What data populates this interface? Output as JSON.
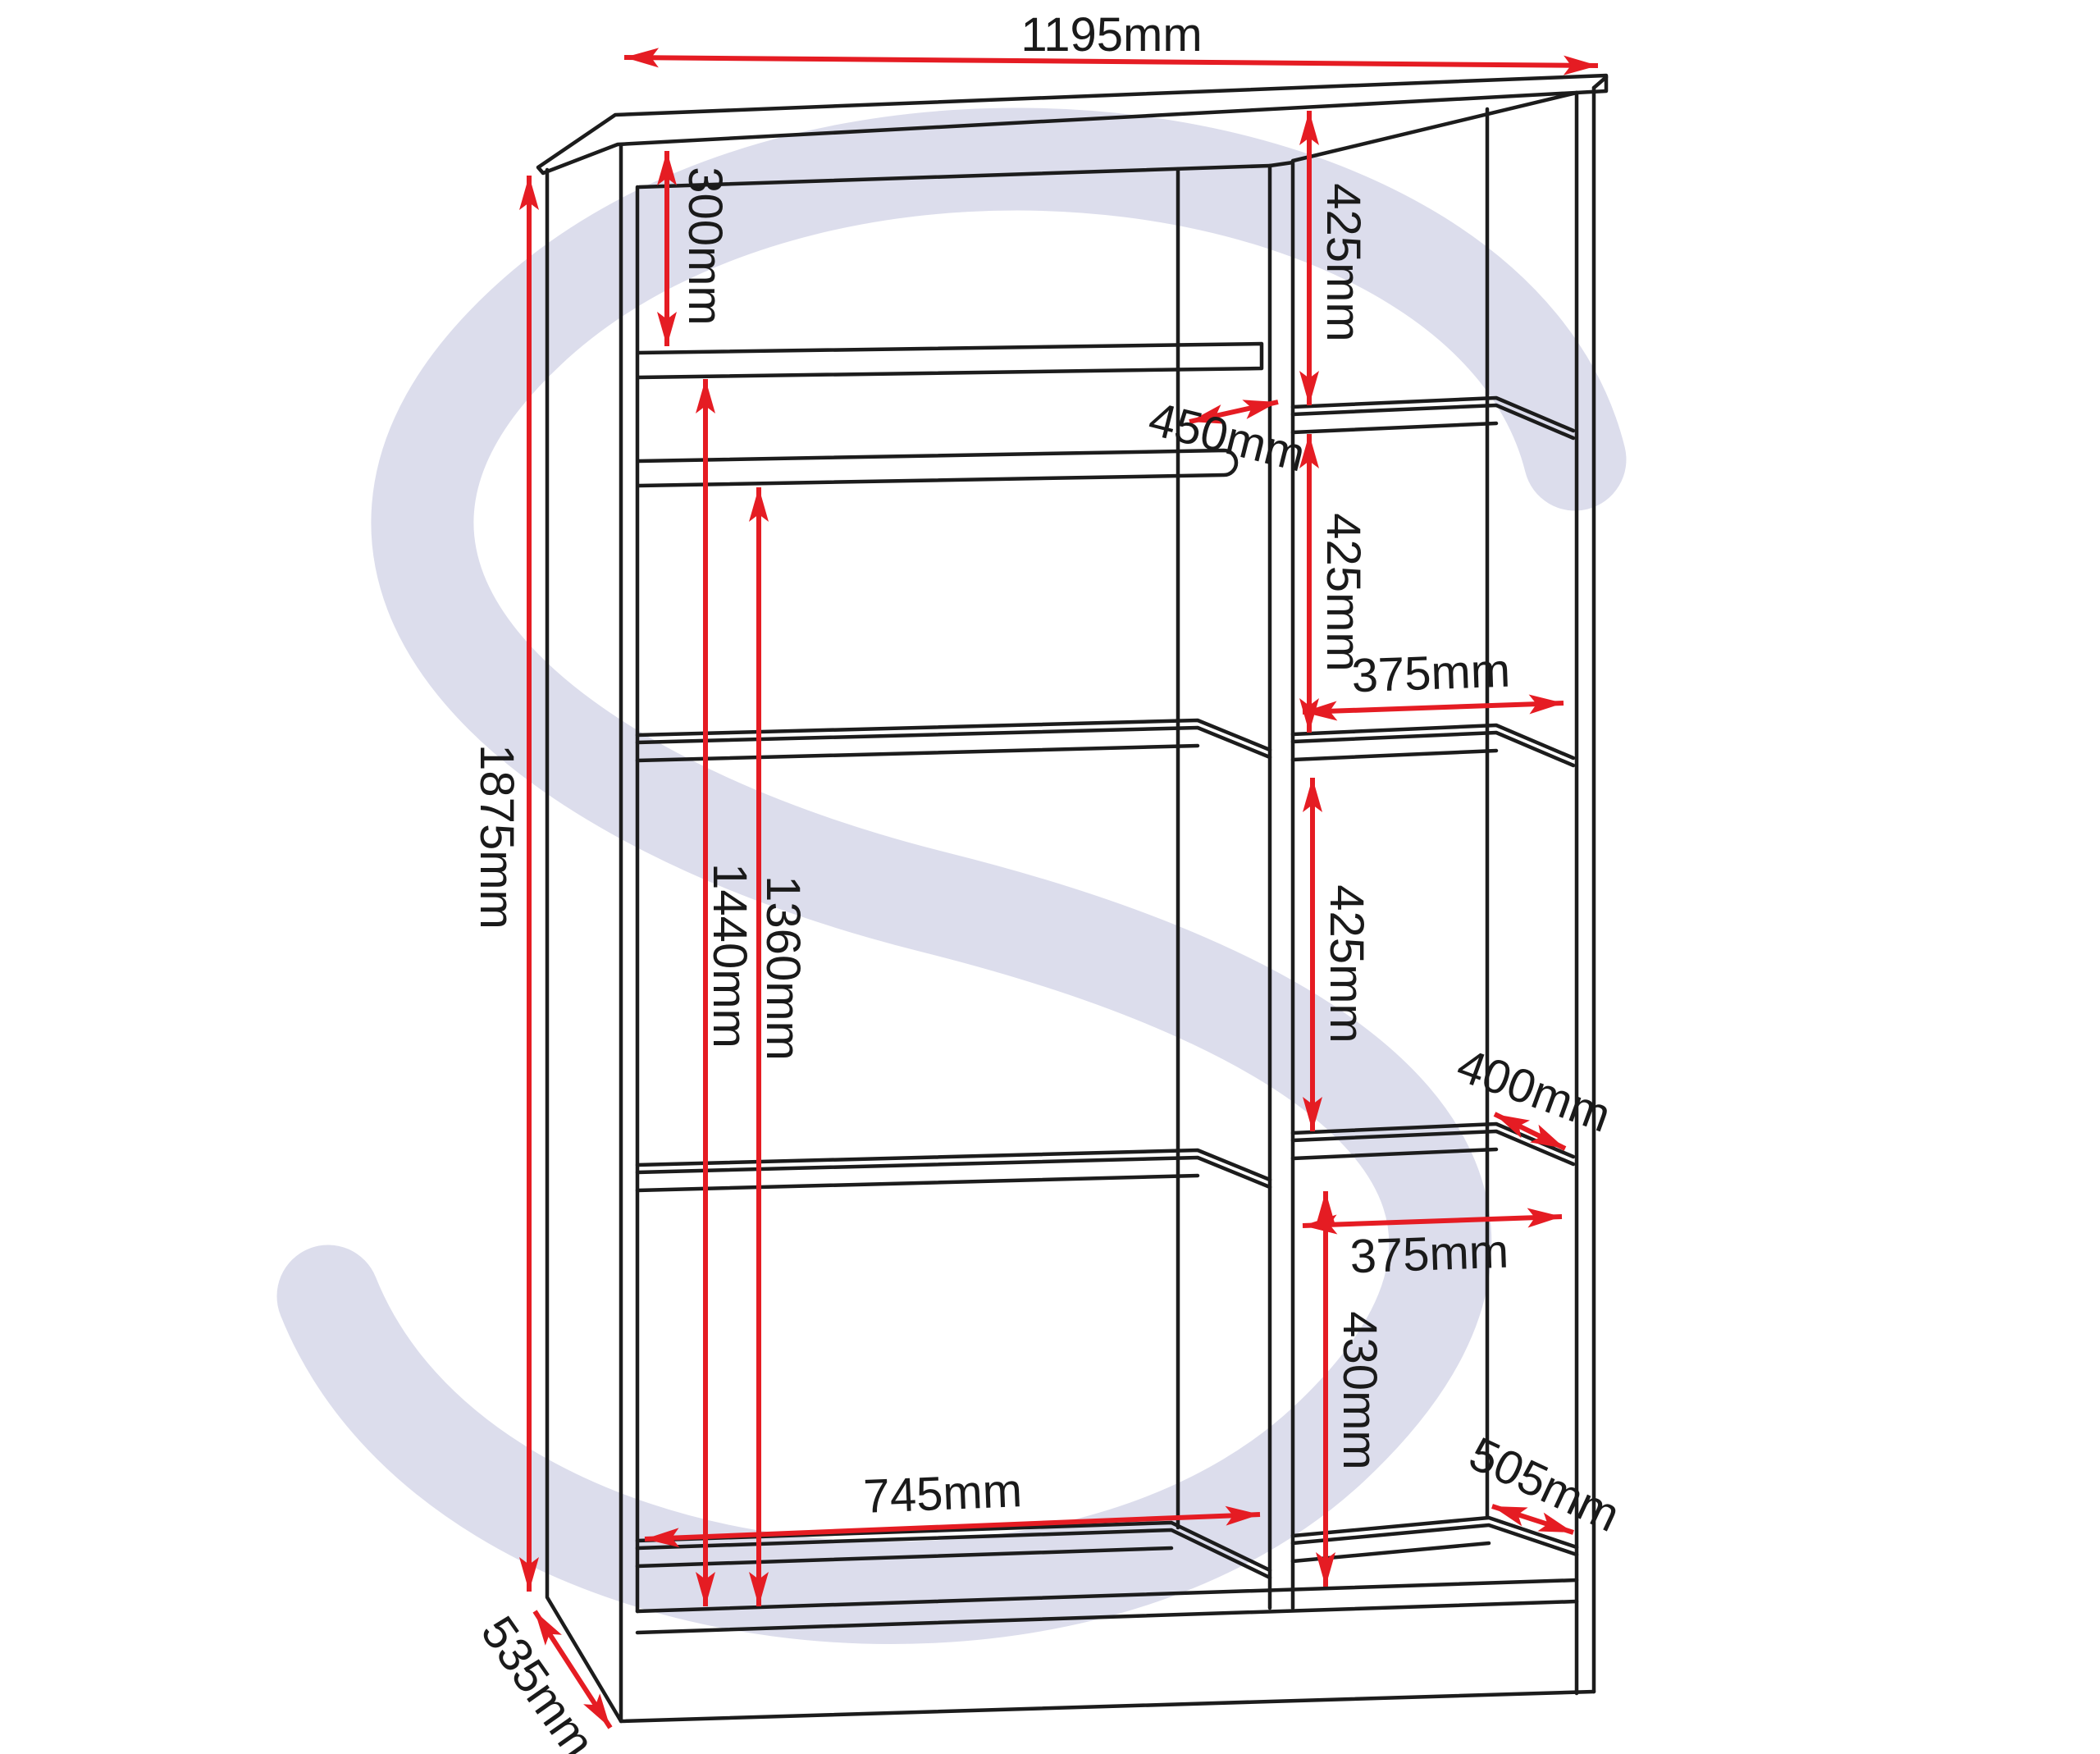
{
  "diagram": {
    "type": "wardrobe-dimension-drawing",
    "units": "mm",
    "watermark_letter": "S",
    "colors": {
      "dimension_red": "#e51c23",
      "line_black": "#1c1c1c",
      "watermark_lavender": "#dcddec"
    },
    "labels": {
      "overall_width": "1195mm",
      "overall_height": "1875mm",
      "overall_depth": "535mm",
      "top_section_height": "300mm",
      "rail_depth": "450mm",
      "left_section_width": "745mm",
      "height_below_top_rail": "1440mm",
      "height_below_lower_rail": "1360mm",
      "right_bay1_height": "425mm",
      "right_bay2_height": "425mm",
      "right_bay3_height": "425mm",
      "right_shelf_width_upper": "375mm",
      "right_shelf_width_lower": "375mm",
      "right_shelf_depth": "400mm",
      "right_bay4_height": "430mm",
      "bottom_shelf_depth": "505mm"
    }
  }
}
